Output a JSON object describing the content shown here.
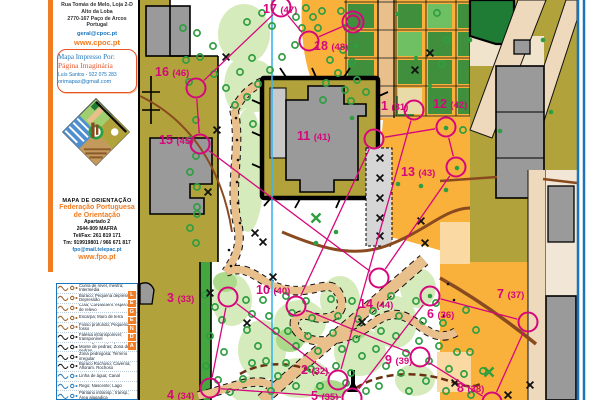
{
  "sidebar": {
    "club": {
      "address_lines": [
        "Rua Tomás de Melo, Loja 2-D",
        "Alto da Loba",
        "2770-167 Paço de Arcos",
        "Portugal"
      ],
      "email": "geral@cpoc.pt",
      "website": "www.cpoc.pt"
    },
    "printer": {
      "title": "Mapa Impresso Por:",
      "name": "Página Imaginária",
      "contact": "Luís Santos - 922 075 283",
      "email": "orimapas@gmail.com"
    },
    "federation": {
      "map_type": "MAPA DE ORIENTAÇÃO",
      "name_line1": "Federação Portuguesa",
      "name_line2": "de Orientação",
      "address_lines": [
        "Apartado 2",
        "2644-909 MAFRA",
        "Tel/Fax: 261 819 171",
        "Tm: 919919801 / 966 671 817"
      ],
      "email": "fpo@mail.telepac.pt",
      "website": "www.fpo.pt"
    },
    "legend": {
      "title": "LEGENDA",
      "rows": [
        {
          "icon": "contour-lines",
          "color": "#9b5f27",
          "label": "Curva de nível, mestra; Intermédia"
        },
        {
          "icon": "pit-depression",
          "color": "#9b5f27",
          "label": "Buraco; Pequena depressão; Depressão"
        },
        {
          "icon": "knoll-special-relief",
          "color": "#9b5f27",
          "label": "Cota; Curva/Elem. especial de relevo"
        },
        {
          "icon": "earth-bank-wall",
          "color": "#9b5f27",
          "label": "Escarpa; Muro de terra"
        },
        {
          "icon": "ditch",
          "color": "#9b5f27",
          "label": "Fosso profundo; Pequeno fosso"
        },
        {
          "icon": "cliff",
          "color": "#1a1a1a",
          "label": "Falésia intransponível; transponível"
        },
        {
          "icon": "boulders-stones",
          "color": "#1a1a1a",
          "label": "Pedra grande; pequena; Monte de pedras; Zona de pedras"
        },
        {
          "icon": "stony-ground",
          "color": "#1a1a1a",
          "label": "Zona pedregosa; Terreno irregular"
        },
        {
          "icon": "rock-hole-cave",
          "color": "#1a1a1a",
          "label": "Buraco Rochoso; Caverna; Afloram. Rochoso"
        },
        {
          "icon": "watercourse-canal",
          "color": "#2d7fc1",
          "label": "Linha de água; Canal"
        },
        {
          "icon": "spring-lake",
          "color": "#2d7fc1",
          "label": "Rego; Nascente; Lago"
        },
        {
          "icon": "marsh",
          "color": "#2d7fc1",
          "label": "Pântano intransp.; transp.; Área alagadiça"
        },
        {
          "icon": "water-hole-special",
          "color": "#2d7fc1",
          "label": "Buraco com água; Elemento especial"
        }
      ]
    }
  },
  "map": {
    "colors": {
      "olive": "#b1a23b",
      "orange": "#f9b13c",
      "path_tan": "#e9c08c",
      "road_beige": "#eed9bc",
      "building_grey": "#9a9a9a",
      "forest_light": "#d6ebbc",
      "tree": "#2f9e41",
      "hedge": "#3f8f3d",
      "dark_green": "#1f7c35",
      "contour_brown": "#8a4a1f",
      "course": "#d6077c",
      "north_line_blue": "#3ab5ea",
      "border_blue": "#1b75bb"
    },
    "north_line_x": 272,
    "finish": {
      "x": 353,
      "y": 22
    },
    "course_order": [
      "1",
      "2",
      "3",
      "4",
      "5",
      "6",
      "7",
      "8",
      "9",
      "10",
      "11",
      "12",
      "13",
      "14",
      "15",
      "16",
      "17",
      "18",
      "F"
    ],
    "controls": [
      {
        "n": "1",
        "c": "(31)",
        "lx": 381,
        "ly": 110,
        "cx": 414,
        "cy": 110
      },
      {
        "n": "2",
        "c": "(32)",
        "lx": 301,
        "ly": 374,
        "cx": 338,
        "cy": 380
      },
      {
        "n": "3",
        "c": "(33)",
        "lx": 167,
        "ly": 302,
        "cx": 228,
        "cy": 297
      },
      {
        "n": "4",
        "c": "(34)",
        "lx": 167,
        "ly": 399,
        "cx": 210,
        "cy": 388
      },
      {
        "n": "5",
        "c": "(35)",
        "lx": 311,
        "ly": 400,
        "cx": 352,
        "cy": 398
      },
      {
        "n": "6",
        "c": "(36)",
        "lx": 427,
        "ly": 318,
        "cx": 430,
        "cy": 296
      },
      {
        "n": "7",
        "c": "(37)",
        "lx": 497,
        "ly": 298,
        "cx": 528,
        "cy": 322
      },
      {
        "n": "8",
        "c": "(38)",
        "lx": 457,
        "ly": 392,
        "cx": 492,
        "cy": 402
      },
      {
        "n": "9",
        "c": "(39)",
        "lx": 385,
        "ly": 364,
        "cx": 420,
        "cy": 357
      },
      {
        "n": "10",
        "c": "(40)",
        "lx": 256,
        "ly": 294,
        "cx": 296,
        "cy": 306
      },
      {
        "n": "11",
        "c": "(41)",
        "lx": 297,
        "ly": 140,
        "cx": 374,
        "cy": 139
      },
      {
        "n": "12",
        "c": "(42)",
        "lx": 433,
        "ly": 108,
        "cx": 446,
        "cy": 127
      },
      {
        "n": "13",
        "c": "(43)",
        "lx": 401,
        "ly": 176,
        "cx": 456,
        "cy": 167
      },
      {
        "n": "14",
        "c": "(44)",
        "lx": 359,
        "ly": 308,
        "cx": 379,
        "cy": 278
      },
      {
        "n": "15",
        "c": "(45)",
        "lx": 159,
        "ly": 144,
        "cx": 200,
        "cy": 144
      },
      {
        "n": "16",
        "c": "(46)",
        "lx": 155,
        "ly": 76,
        "cx": 196,
        "cy": 88
      },
      {
        "n": "17",
        "c": "(47)",
        "lx": 263,
        "ly": 13,
        "cx": 281,
        "cy": 7
      },
      {
        "n": "18",
        "c": "(48)",
        "lx": 314,
        "ly": 50,
        "cx": 309,
        "cy": 41
      }
    ],
    "trees": [
      [
        183,
        28
      ],
      [
        197,
        33
      ],
      [
        213,
        46
      ],
      [
        186,
        60
      ],
      [
        200,
        57
      ],
      [
        214,
        74
      ],
      [
        189,
        82
      ],
      [
        226,
        88
      ],
      [
        240,
        72
      ],
      [
        252,
        58
      ],
      [
        247,
        22
      ],
      [
        262,
        13
      ],
      [
        272,
        26
      ],
      [
        296,
        17
      ],
      [
        306,
        8
      ],
      [
        313,
        17
      ],
      [
        322,
        11
      ],
      [
        302,
        28
      ],
      [
        318,
        28
      ],
      [
        341,
        11
      ],
      [
        347,
        27
      ],
      [
        330,
        60
      ],
      [
        343,
        50
      ],
      [
        352,
        62
      ],
      [
        338,
        73
      ],
      [
        326,
        83
      ],
      [
        345,
        90
      ],
      [
        357,
        80
      ],
      [
        366,
        92
      ],
      [
        351,
        101
      ],
      [
        323,
        100
      ],
      [
        295,
        45
      ],
      [
        282,
        57
      ],
      [
        270,
        70
      ],
      [
        258,
        84
      ],
      [
        247,
        97
      ],
      [
        235,
        105
      ],
      [
        437,
        13
      ],
      [
        447,
        40
      ],
      [
        442,
        64
      ],
      [
        463,
        130
      ],
      [
        196,
        120
      ],
      [
        190,
        140
      ],
      [
        196,
        156
      ],
      [
        190,
        172
      ],
      [
        197,
        187
      ],
      [
        197,
        207
      ],
      [
        197,
        214
      ],
      [
        190,
        228
      ],
      [
        196,
        243
      ],
      [
        253,
        124
      ],
      [
        205,
        295
      ],
      [
        215,
        307
      ],
      [
        222,
        320
      ],
      [
        210,
        336
      ],
      [
        224,
        352
      ],
      [
        206,
        366
      ],
      [
        218,
        380
      ],
      [
        230,
        392
      ],
      [
        246,
        300
      ],
      [
        252,
        314
      ],
      [
        247,
        330
      ],
      [
        258,
        346
      ],
      [
        252,
        363
      ],
      [
        243,
        379
      ],
      [
        263,
        300
      ],
      [
        269,
        316
      ],
      [
        276,
        331
      ],
      [
        266,
        361
      ],
      [
        278,
        376
      ],
      [
        271,
        391
      ],
      [
        286,
        296
      ],
      [
        292,
        313
      ],
      [
        288,
        331
      ],
      [
        296,
        346
      ],
      [
        286,
        363
      ],
      [
        296,
        386
      ],
      [
        306,
        301
      ],
      [
        312,
        318
      ],
      [
        308,
        336
      ],
      [
        318,
        351
      ],
      [
        311,
        369
      ],
      [
        320,
        386
      ],
      [
        331,
        299
      ],
      [
        338,
        316
      ],
      [
        333,
        333
      ],
      [
        342,
        349
      ],
      [
        336,
        366
      ],
      [
        346,
        383
      ],
      [
        352,
        301
      ],
      [
        358,
        319
      ],
      [
        356,
        339
      ],
      [
        362,
        356
      ],
      [
        351,
        373
      ],
      [
        366,
        391
      ],
      [
        373,
        311
      ],
      [
        381,
        331
      ],
      [
        376,
        349
      ],
      [
        386,
        366
      ],
      [
        379,
        386
      ],
      [
        391,
        296
      ],
      [
        399,
        316
      ],
      [
        396,
        336
      ],
      [
        406,
        353
      ],
      [
        401,
        373
      ],
      [
        409,
        391
      ],
      [
        416,
        301
      ],
      [
        423,
        321
      ],
      [
        419,
        341
      ],
      [
        429,
        361
      ],
      [
        426,
        381
      ],
      [
        436,
        303
      ],
      [
        443,
        323
      ],
      [
        439,
        346
      ],
      [
        449,
        369
      ],
      [
        446,
        391
      ],
      [
        457,
        352
      ],
      [
        464,
        374
      ],
      [
        471,
        395
      ],
      [
        466,
        310
      ],
      [
        476,
        330
      ],
      [
        470,
        352
      ],
      [
        483,
        371
      ]
    ],
    "green_dots": [
      [
        356,
        46
      ],
      [
        398,
        14
      ],
      [
        416,
        58
      ],
      [
        430,
        86
      ],
      [
        352,
        118
      ],
      [
        470,
        40
      ],
      [
        543,
        40
      ],
      [
        551,
        112
      ],
      [
        500,
        131
      ],
      [
        446,
        128
      ],
      [
        457,
        168
      ],
      [
        430,
        296
      ],
      [
        398,
        184
      ],
      [
        421,
        186
      ],
      [
        446,
        190
      ],
      [
        316,
        243
      ],
      [
        336,
        232
      ]
    ],
    "black_dots": [
      [
        236,
        118
      ],
      [
        237,
        140
      ],
      [
        238,
        160
      ],
      [
        237,
        182
      ],
      [
        238,
        203
      ],
      [
        240,
        223
      ],
      [
        229,
        250
      ],
      [
        231,
        266
      ],
      [
        448,
        284
      ],
      [
        454,
        300
      ],
      [
        444,
        316
      ]
    ],
    "crosses": [
      [
        226,
        57
      ],
      [
        430,
        53
      ],
      [
        415,
        70
      ],
      [
        380,
        158
      ],
      [
        380,
        178
      ],
      [
        380,
        198
      ],
      [
        380,
        218
      ],
      [
        380,
        236
      ],
      [
        217,
        130
      ],
      [
        208,
        192
      ],
      [
        255,
        233
      ],
      [
        263,
        242
      ],
      [
        273,
        277
      ],
      [
        210,
        293
      ],
      [
        247,
        323
      ],
      [
        362,
        322
      ],
      [
        421,
        221
      ],
      [
        425,
        243
      ],
      [
        508,
        395
      ],
      [
        530,
        385
      ],
      [
        455,
        383
      ]
    ],
    "green_crosses": [
      [
        316,
        218
      ],
      [
        489,
        372
      ]
    ]
  }
}
